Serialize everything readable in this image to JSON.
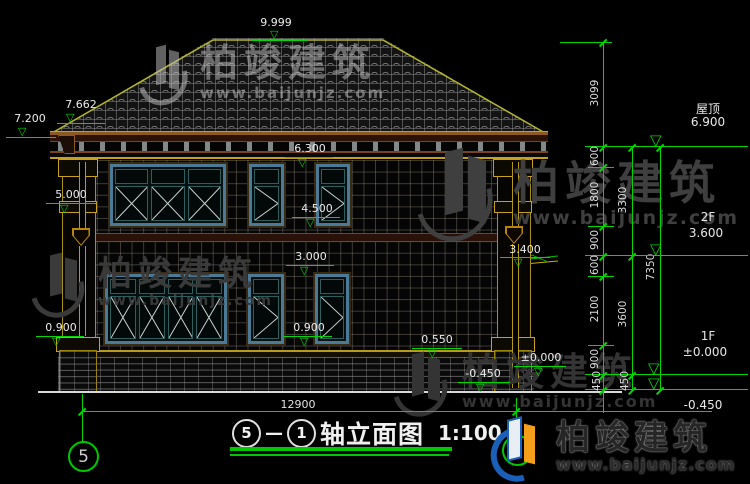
{
  "drawing": {
    "title": {
      "axis_start": "5",
      "dash": "—",
      "axis_end": "1",
      "name": "轴立面图",
      "scale": "1:100"
    },
    "marks": {
      "m9999": "9.999",
      "m7662": "7.662",
      "m7200": "7.200",
      "m6300": "6.300",
      "m5000": "5.000",
      "m4500": "4.500",
      "m3400": "3.400",
      "m3000": "3.000",
      "m0900l": "0.900",
      "m0900c": "0.900",
      "m0550": "0.550",
      "m0000": "±0.000",
      "mneg450": "-0.450"
    },
    "levels": {
      "roof_name": "屋顶",
      "roof_value": "6.900",
      "f2_name": "2F",
      "f2_value": "3.600",
      "f1_name": "1F",
      "f1_value": "±0.000",
      "below_value": "-0.450"
    },
    "chains": {
      "inner": [
        "3099",
        "600",
        "1800",
        "900",
        "600",
        "2100",
        "900",
        "450"
      ],
      "middle": [
        "3300",
        "3600",
        "450"
      ],
      "outer": [
        "7350"
      ]
    },
    "total_width": "12900",
    "axes": {
      "left": "5",
      "right": "1"
    }
  },
  "watermark": {
    "name": "柏竣建筑",
    "url": "www.baijunjz.com"
  }
}
